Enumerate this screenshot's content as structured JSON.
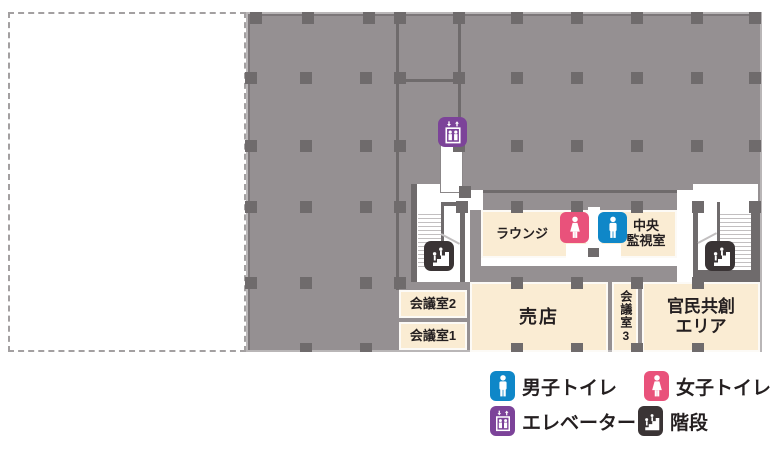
{
  "map": {
    "rooms": {
      "lounge": {
        "label": "ラウンジ"
      },
      "monitor": {
        "line1": "中央",
        "line2": "監視室"
      },
      "meeting2": {
        "label": "会議室2"
      },
      "meeting1": {
        "label": "会議室1"
      },
      "shop": {
        "label": "売店"
      },
      "meeting3": {
        "label": "会議室3"
      },
      "co_creation": {
        "line1": "官民共創",
        "line2": "エリア"
      }
    },
    "pillars": [
      [
        250,
        12
      ],
      [
        302,
        12
      ],
      [
        363,
        12
      ],
      [
        394,
        12
      ],
      [
        453,
        12
      ],
      [
        511,
        12
      ],
      [
        571,
        12
      ],
      [
        631,
        12
      ],
      [
        691,
        12
      ],
      [
        749,
        12
      ],
      [
        245,
        72
      ],
      [
        300,
        72
      ],
      [
        360,
        72
      ],
      [
        394,
        72
      ],
      [
        453,
        72
      ],
      [
        511,
        72
      ],
      [
        571,
        72
      ],
      [
        631,
        72
      ],
      [
        691,
        72
      ],
      [
        749,
        72
      ],
      [
        245,
        140
      ],
      [
        300,
        140
      ],
      [
        360,
        140
      ],
      [
        394,
        140
      ],
      [
        453,
        140
      ],
      [
        511,
        140
      ],
      [
        571,
        140
      ],
      [
        631,
        140
      ],
      [
        691,
        140
      ],
      [
        749,
        140
      ],
      [
        245,
        201
      ],
      [
        300,
        201
      ],
      [
        360,
        201
      ],
      [
        394,
        201
      ],
      [
        456,
        201
      ],
      [
        511,
        201
      ],
      [
        571,
        201
      ],
      [
        631,
        201
      ],
      [
        692,
        201
      ],
      [
        749,
        201
      ],
      [
        245,
        277
      ],
      [
        300,
        277
      ],
      [
        360,
        277
      ],
      [
        394,
        277
      ],
      [
        511,
        277
      ],
      [
        571,
        277
      ],
      [
        631,
        277
      ],
      [
        692,
        277
      ],
      [
        300,
        343
      ],
      [
        360,
        343
      ],
      [
        511,
        343
      ],
      [
        571,
        343
      ],
      [
        631,
        343
      ],
      [
        692,
        343
      ],
      [
        459,
        186
      ]
    ]
  },
  "legend": {
    "items": [
      {
        "icon": "male-toilet-icon",
        "label": "男子トイレ"
      },
      {
        "icon": "female-toilet-icon",
        "label": "女子トイレ"
      },
      {
        "icon": "elevator-icon",
        "label": "エレベーター"
      },
      {
        "icon": "stairs-icon",
        "label": "階段"
      }
    ]
  },
  "colors": {
    "floor": "#959092",
    "pillar": "#6f6b6c",
    "room": "#faecd3",
    "male": "#0f87c8",
    "female": "#e9527b",
    "elevator": "#7c4399",
    "stairs": "#3a3435",
    "text": "#241f20",
    "tread": "#c2bfc0",
    "border": "#b9b6b7",
    "dash": "#a3a0a1"
  }
}
